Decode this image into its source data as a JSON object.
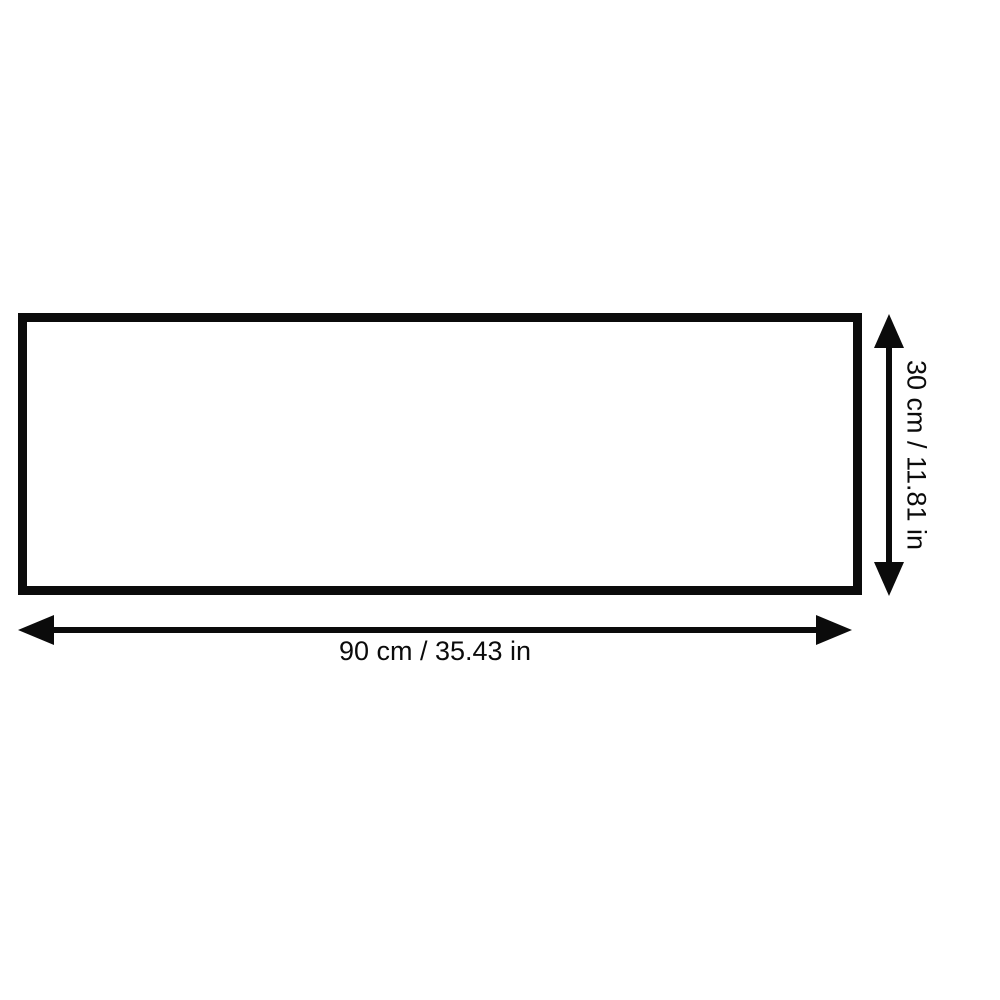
{
  "diagram": {
    "width_label": "90 cm / 35.43 in",
    "height_label": "30 cm / 11.81 in"
  },
  "colors": {
    "line": "#0b0b0b",
    "background": "#ffffff"
  }
}
